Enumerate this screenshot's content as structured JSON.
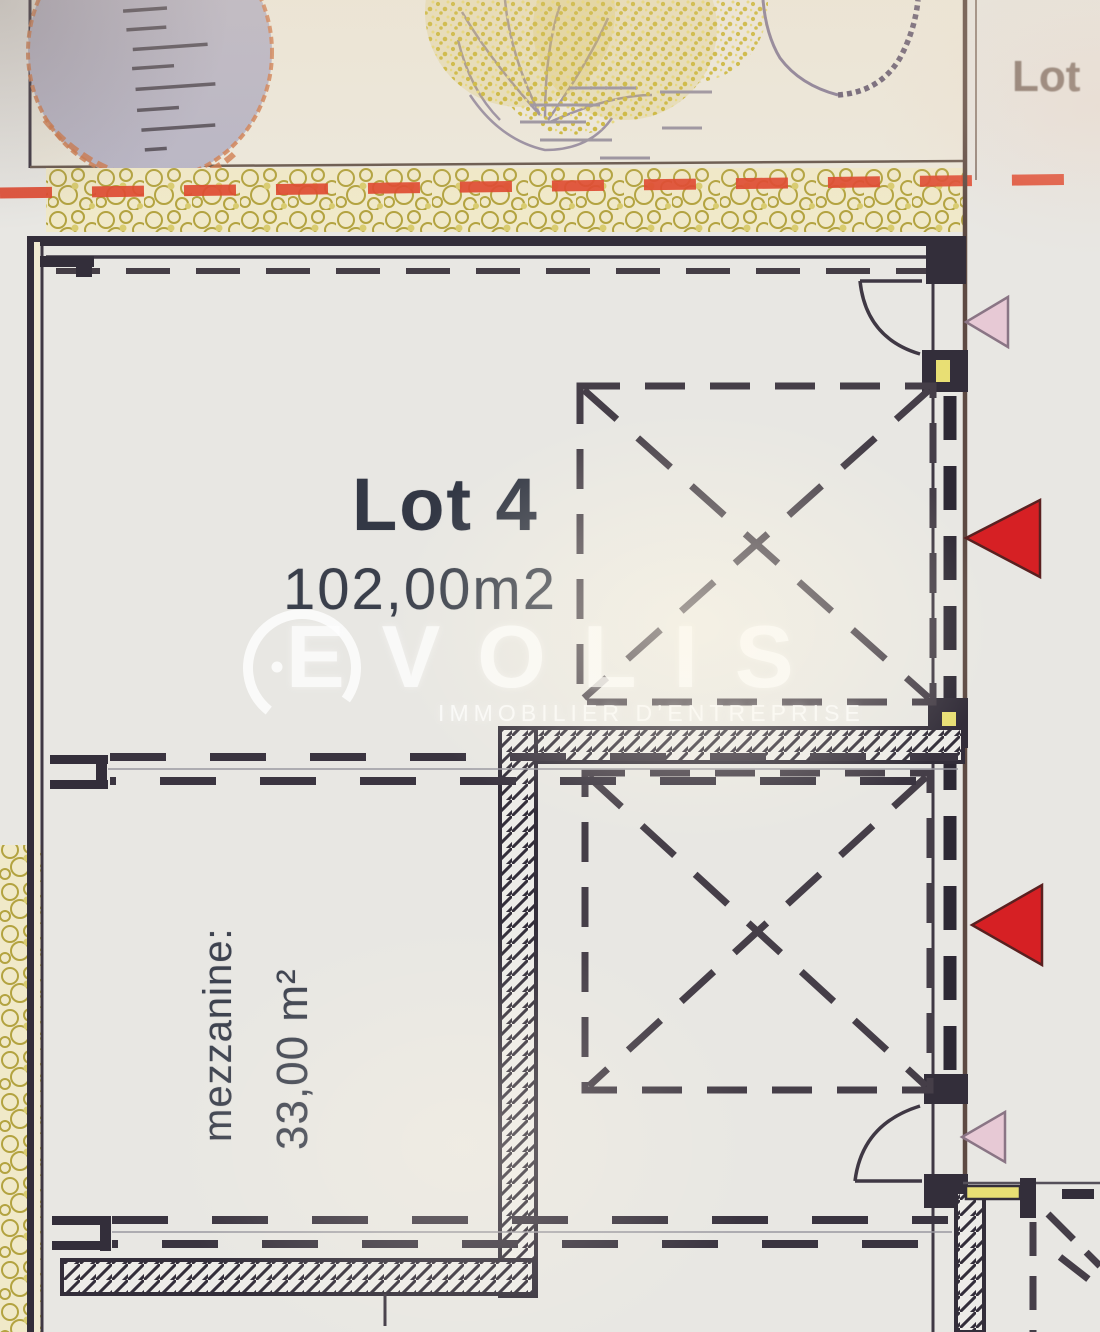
{
  "plan": {
    "main_lot": {
      "name": "Lot 4",
      "area": "102,00m2"
    },
    "mezzanine": {
      "label": "mezzanine:",
      "area": "33,00 m²"
    },
    "adjacent_lot_label": "Lot"
  },
  "watermark": {
    "brand": "EVOLIS",
    "tagline": "IMMOBILIER D’ENTREPRISE"
  },
  "markers": [
    {
      "name": "pink-triangle-marker",
      "position": "right-wall-top"
    },
    {
      "name": "red-triangle-marker",
      "position": "right-wall-upper"
    },
    {
      "name": "red-triangle-marker",
      "position": "right-wall-lower"
    },
    {
      "name": "pink-triangle-marker",
      "position": "right-wall-bottom"
    }
  ],
  "colors": {
    "paper": "#e8e7e3",
    "strip_paper": "#ece8dc",
    "ink": "#3f3844",
    "wall_dark": "#332e3a",
    "boundary_brown": "#5d4a43",
    "red_dashed": "#df4a31",
    "red_marker": "#d62024",
    "pink_marker": "#e7c9d5",
    "gravel_line": "#b3a340",
    "gravel_fill": "#f0e9c9",
    "tree_yellow": "#ccb83e",
    "tree_gray": "#b9b6c6",
    "tree_coral": "#d08055",
    "tree_purple": "#8b8098",
    "accent_yellow": "#e8df74",
    "text_dark": "#333845",
    "text_muted": "#75655c",
    "watermark": "#ffffff"
  }
}
